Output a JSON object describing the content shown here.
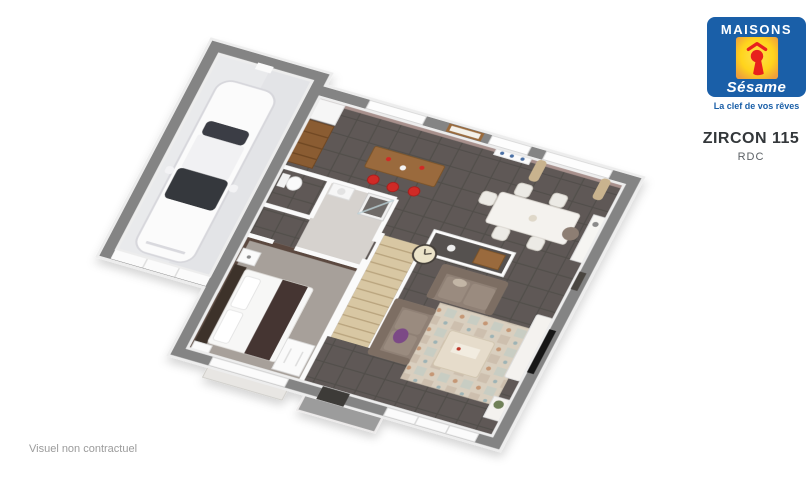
{
  "brand": {
    "wordmark": "MAISONS",
    "script_name": "Sésame",
    "tagline": "La clef de vos rêves"
  },
  "plan": {
    "model_name": "ZIRCON 115",
    "level_label": "RDC"
  },
  "footer": {
    "disclaimer": "Visuel non contractuel"
  },
  "palette": {
    "brand_blue": "#1a5fa8",
    "brand_yellow": "#ffd91f",
    "brand_red": "#e8211d",
    "wall_gray": "#848484",
    "tile_floor": "#5e5956",
    "mauve_wall": "#a8908c",
    "bedroom_wall_brown": "#5c4a41",
    "carpet": "#a7a09a",
    "bath_floor": "#d6d2ce",
    "garage_floor": "#e9eaec",
    "stair_wood": "#d8c7a3",
    "bar_wood": "#9a6a3e",
    "stool_red": "#d02b27",
    "sofa_taupe": "#8f8075",
    "cushion_purple": "#7b4a86",
    "rug_beige": "#d9cfbf",
    "curtain_beige": "#c9b38e"
  }
}
